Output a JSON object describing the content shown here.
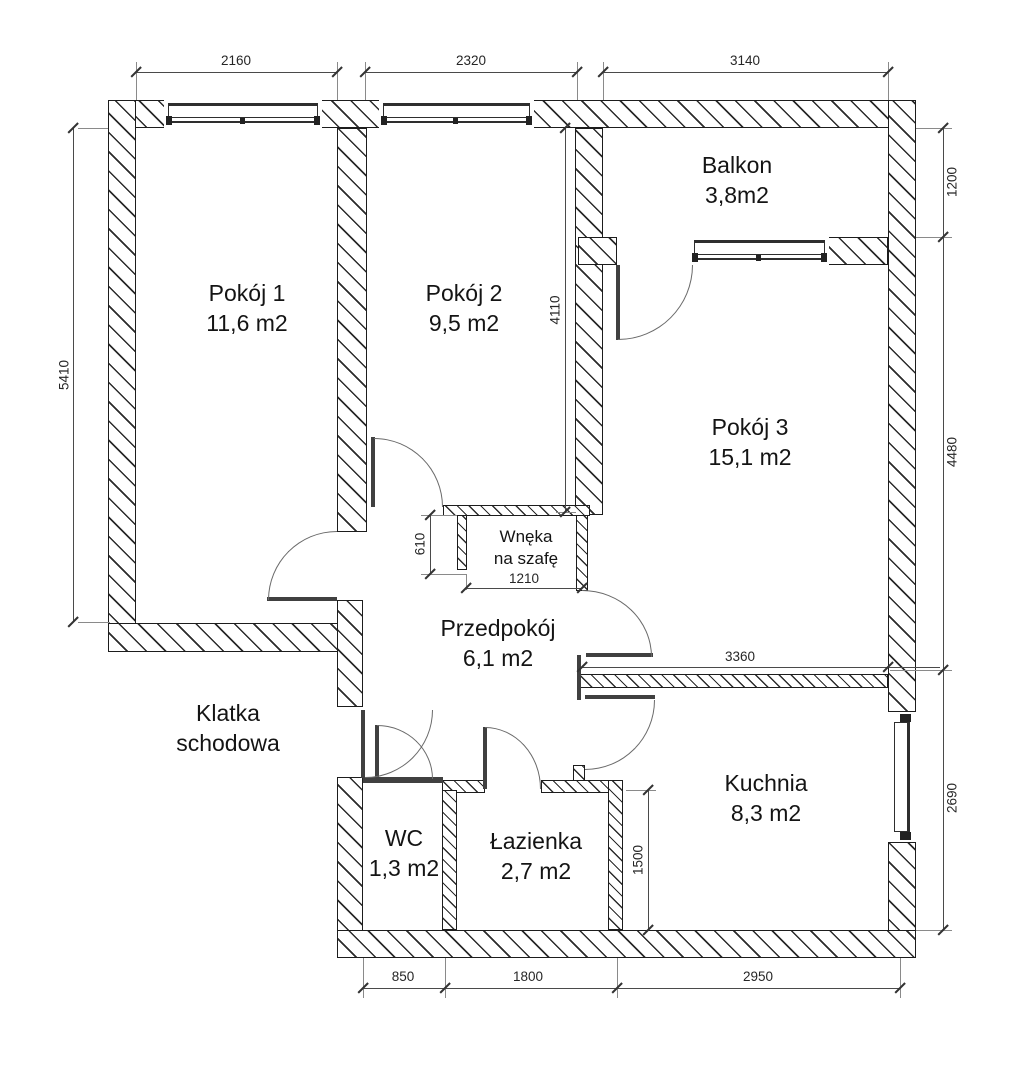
{
  "drawing_type": "apartment floor plan",
  "rooms": {
    "pokoj1": {
      "line1": "Pokój 1",
      "line2": "11,6 m2"
    },
    "pokoj2": {
      "line1": "Pokój 2",
      "line2": "9,5 m2"
    },
    "balkon": {
      "line1": "Balkon",
      "line2": "3,8m2"
    },
    "pokoj3": {
      "line1": "Pokój 3",
      "line2": "15,1 m2"
    },
    "wneka": {
      "line1": "Wnęka",
      "line2": "na szafę"
    },
    "przedpokoj": {
      "line1": "Przedpokój",
      "line2": "6,1 m2"
    },
    "klatka": {
      "line1": "Klatka",
      "line2": "schodowa"
    },
    "wc": {
      "line1": "WC",
      "line2": "1,3 m2"
    },
    "lazienka": {
      "line1": "Łazienka",
      "line2": "2,7 m2"
    },
    "kuchnia": {
      "line1": "Kuchnia",
      "line2": "8,3 m2"
    }
  },
  "dimensions": {
    "top_pokoj1": "2160",
    "top_pokoj2": "2320",
    "top_balkon": "3140",
    "right_balkon": "1200",
    "right_pokoj3": "4480",
    "right_kuchnia": "2690",
    "left_pokoj1": "5410",
    "pokoj2_height": "4110",
    "wneka_depth": "610",
    "wneka_width": "1210",
    "kuchnia_wall": "3360",
    "lazienka_height": "1500",
    "bottom_wc": "850",
    "bottom_lazienka": "1800",
    "bottom_kuchnia": "2950"
  },
  "colors": {
    "line": "#1d1d1d",
    "dimension": "#4a4a4a",
    "background": "#ffffff"
  }
}
